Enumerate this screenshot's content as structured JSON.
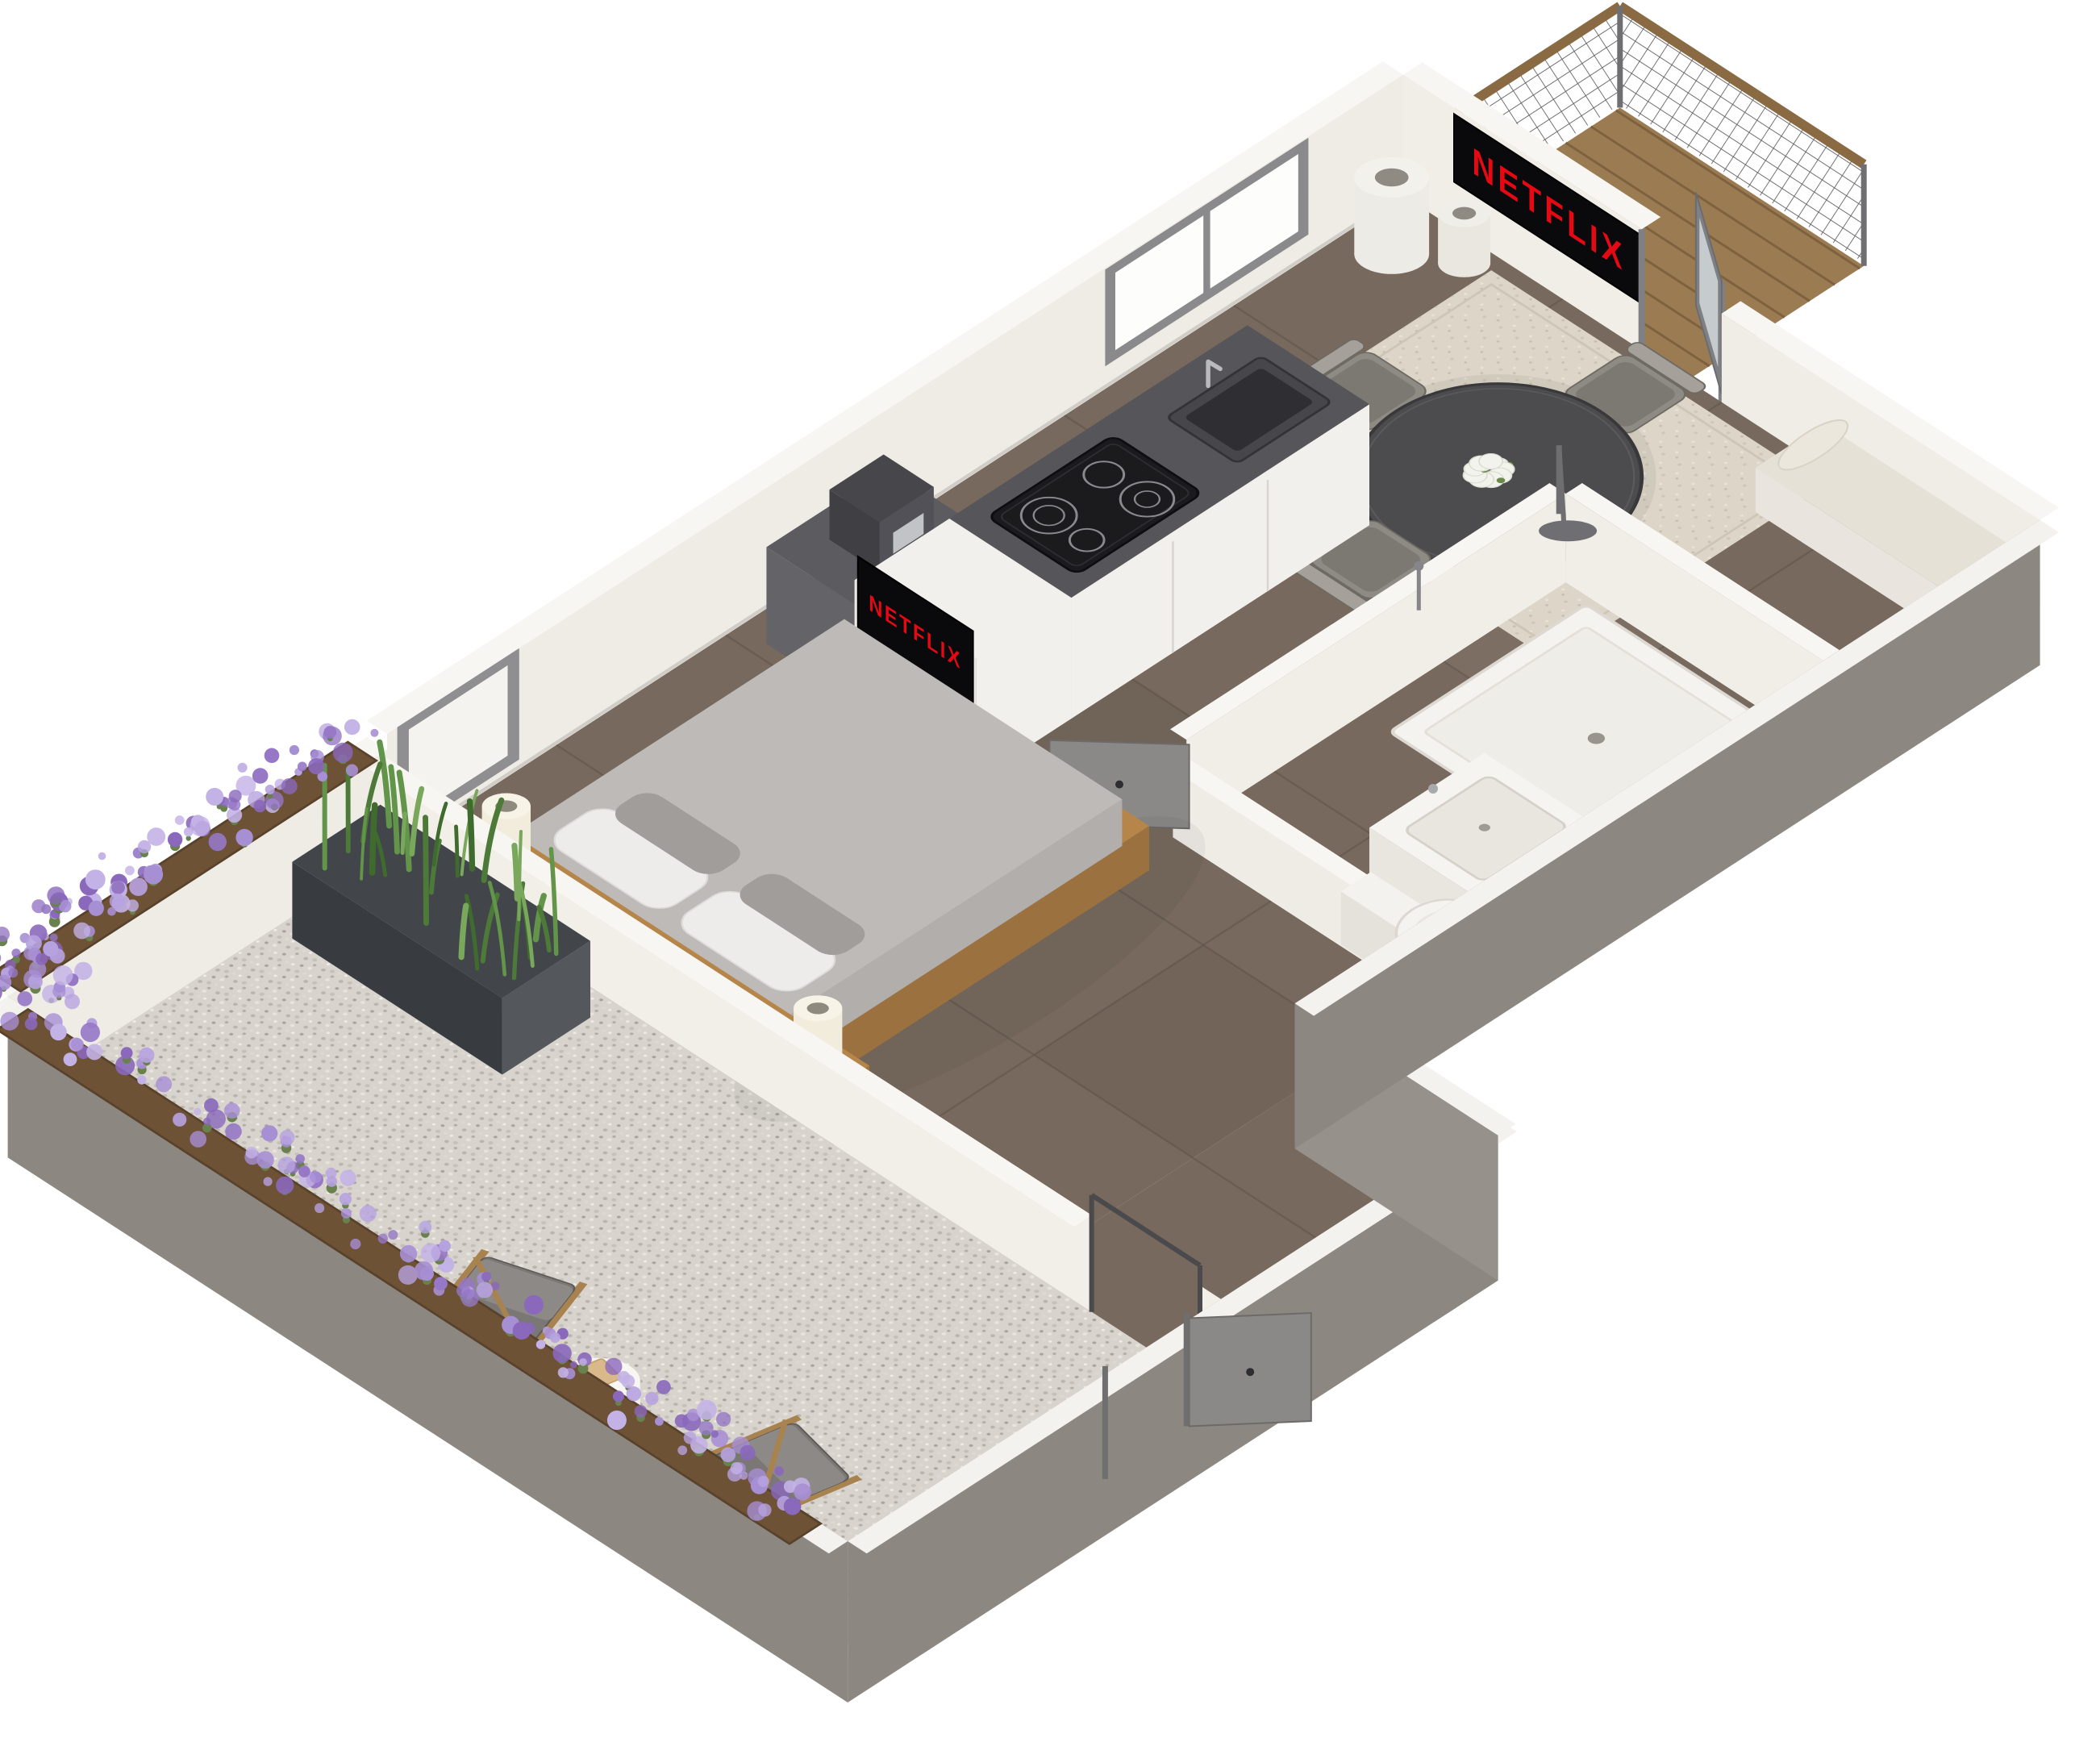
{
  "tv_wall": {
    "label": "NETFLIX"
  },
  "tv_stand": {
    "label": "NETFLIX"
  },
  "brand": {
    "netflix_red": "#e50914",
    "screen_black": "#0a0a0c"
  },
  "palette": {
    "wall_white": "#efebe5",
    "wall_cap": "#f8f6f2",
    "wall_inner": "#f2efe9",
    "concrete": "#8d8781",
    "concrete_dark": "#7e7872",
    "floor_tile": "#77695d",
    "grout": "#5f544a",
    "gravel": "#d8d4cd",
    "rug": "#dcd5c8",
    "deck_wood": "#9b7c52",
    "deck_line": "#7e623f",
    "bed_wood": "#b5854a",
    "mattress": "#bdbab7",
    "pillow_white": "#edecea",
    "pillow_gray": "#a19d9a",
    "table_top": "#4c4c4e",
    "chair_gray": "#8e8a84",
    "counter_dark": "#55555a",
    "cabinet_white": "#f2f0ec",
    "fixture_white": "#f5f3ef",
    "door_gray": "#8b8987",
    "frame_gray": "#6f6f71",
    "rail_wood": "#8a6a43",
    "plant_green": "#629449",
    "lavender": "#a78fd4",
    "flower_box_wood": "#6d5236",
    "lamp_cream": "#f1ecdc",
    "glass_white": "#fdfdfc"
  }
}
